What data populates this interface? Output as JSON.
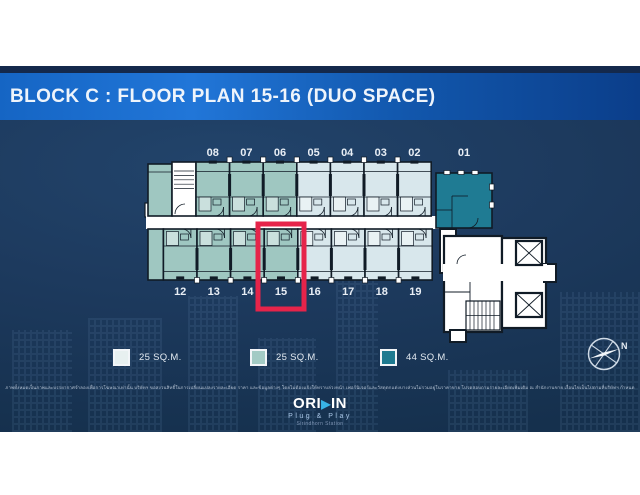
{
  "title": "BLOCK C : FLOOR PLAN 15-16 (DUO SPACE)",
  "floor_plan": {
    "top_row": [
      {
        "number": "08",
        "type": "medium"
      },
      {
        "number": "07",
        "type": "medium"
      },
      {
        "number": "06",
        "type": "medium"
      },
      {
        "number": "05",
        "type": "light"
      },
      {
        "number": "04",
        "type": "light"
      },
      {
        "number": "03",
        "type": "light"
      },
      {
        "number": "02",
        "type": "light"
      }
    ],
    "corner_unit": {
      "number": "01",
      "type": "dark"
    },
    "bottom_row": [
      {
        "number": "12",
        "type": "medium"
      },
      {
        "number": "13",
        "type": "medium"
      },
      {
        "number": "14",
        "type": "medium"
      },
      {
        "number": "15",
        "type": "medium",
        "highlighted": true
      },
      {
        "number": "16",
        "type": "light"
      },
      {
        "number": "17",
        "type": "light"
      },
      {
        "number": "18",
        "type": "light"
      },
      {
        "number": "19",
        "type": "light"
      }
    ],
    "highlighted_unit": "15",
    "unit_colors": {
      "light": "#d8e7ec",
      "medium": "#9fc7c1",
      "dark": "#1f7b93"
    },
    "highlight_color": "#e6244a"
  },
  "legend": [
    {
      "label": "25 SQ.M.",
      "color": "#e7f0f0"
    },
    {
      "label": "25 SQ.M.",
      "color": "#a3cbc5"
    },
    {
      "label": "44 SQ.M.",
      "color": "#1e7a90"
    }
  ],
  "compass": {
    "label": "N"
  },
  "disclaimer": "ภาพทั้งหมดเป็นภาพและบรรยากาศจำลองเพื่อการโฆษณาเท่านั้น บริษัทฯ ขอสงวนสิทธิ์ในการเปลี่ยนแปลงรายละเอียด ราคา และข้อมูลต่างๆ โดยไม่ต้องแจ้งให้ทราบล่วงหน้า เฟอร์นิเจอร์และวัสดุตกแต่งบางส่วนไม่รวมอยู่ในราคาขาย โปรดสอบถามรายละเอียดเพิ่มเติม ณ สำนักงานขาย เงื่อนไขเป็นไปตามที่บริษัทฯ กำหนด",
  "logo": {
    "brand_prefix": "ORI",
    "play_icon": "▶",
    "brand_suffix": "IN",
    "tagline": "Plug & Play",
    "project": "Sirindhorn Station"
  }
}
